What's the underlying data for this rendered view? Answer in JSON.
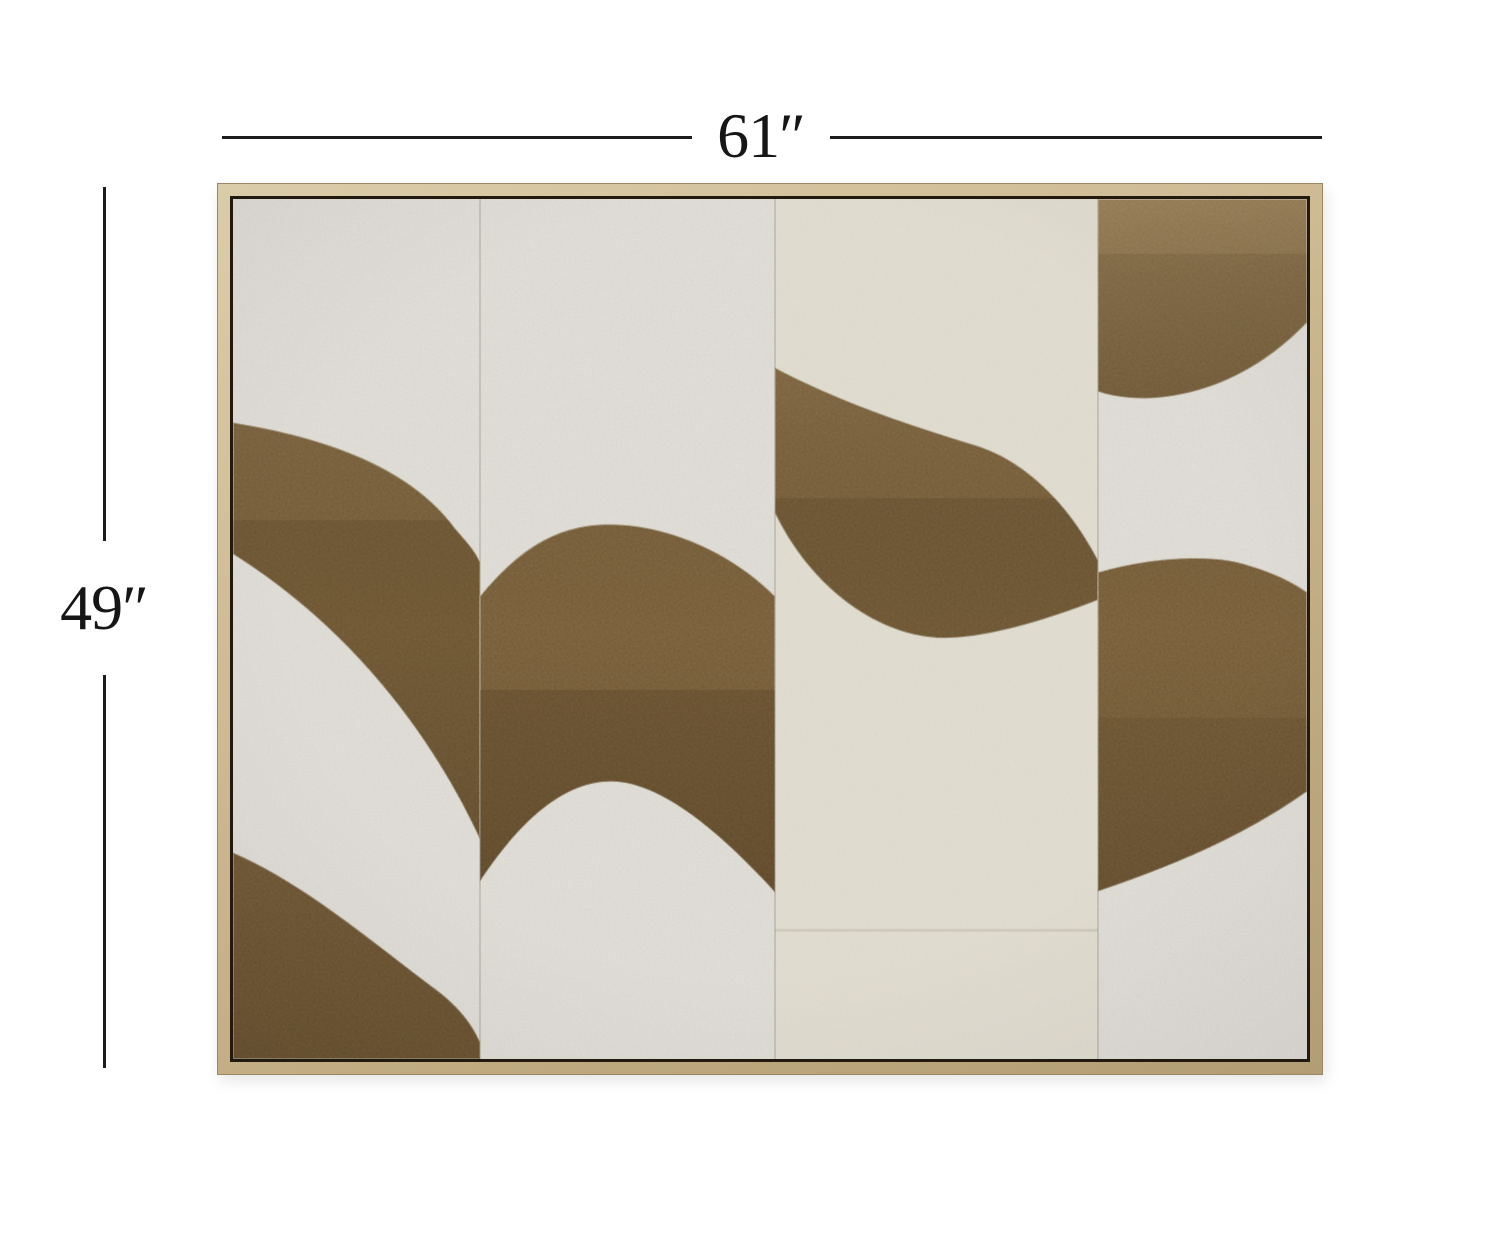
{
  "page": {
    "title": "Framed abstract canvas wall art — product dimensions",
    "background": "#ffffff"
  },
  "dimension_annotations": {
    "width": {
      "label": "61″"
    },
    "height": {
      "label": "49″"
    },
    "line_color": "#1c1c1c",
    "text_color": "#161616"
  },
  "artwork": {
    "description": "Abstract painting of alternating textured bronze-brown and white wave bands across four canvas panels in a natural wood floater frame",
    "frame": {
      "wood_light": "#dbcca9",
      "wood_mid": "#c5b28c",
      "wood_dark": "#b29d74",
      "inner_gap": "#221a0e"
    },
    "canvas": {
      "white": "#e6e3dd",
      "cream": "#e3d9c4",
      "seam": "#5a4a34"
    },
    "paint": {
      "bronze": "#8e7248",
      "bronze_light": "#a4895e",
      "bronze_dark": "#6e5634",
      "ridge_white": "#efe9dc"
    },
    "panels": 4
  }
}
